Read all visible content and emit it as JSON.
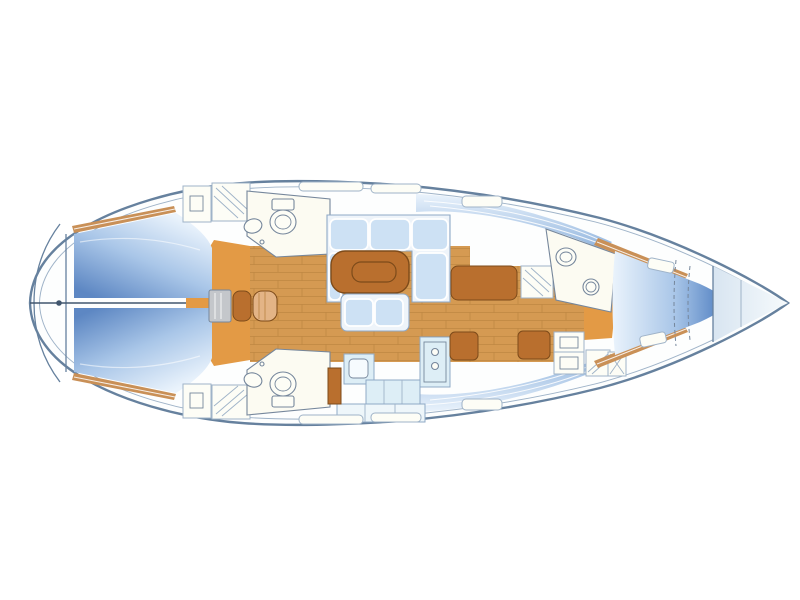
{
  "canvas": {
    "width": 800,
    "height": 600,
    "background": "#ffffff"
  },
  "diagram": {
    "type": "sailing-yacht-interior-floor-plan",
    "view": "top-down",
    "orientation": "bow-right-stern-left",
    "palette": {
      "line": "#66819e",
      "line_soft": "#9fb3c8",
      "accent_dark": "#41566e",
      "hull_fill": "#fdfefe",
      "berth_light": "#eaf3fc",
      "berth_mid": "#a9c6e8",
      "berth_deep": "#5d87c3",
      "vberth_deep": "#4c7cbf",
      "side_deep": "#8fb3dd",
      "bow_light": "#d8e5f1",
      "cushion": "#cde1f4",
      "cushion_edge": "#8fa9c6",
      "settee_base": "#eef4fa",
      "wood": "#d59a52",
      "wood_line": "#b5813c",
      "floor_orange": "#e39a45",
      "furniture_brown": "#b96f2e",
      "furniture_brown_dark": "#7d4b1a",
      "shelf_wood": "#c99057",
      "counter": "#ddeef6",
      "counter_light": "#eef6fa",
      "fixture_fill": "#fdfdf6",
      "fixture_line": "#76879c",
      "room_fill": "#fcfbf2",
      "steps_gray": "#c4c7cb"
    },
    "zones": [
      {
        "id": "stern-platform",
        "features": [
          "transom-curve",
          "backstay-fitting",
          "stern-bulkhead"
        ]
      },
      {
        "id": "aft-cabin-port",
        "features": [
          "double-berth",
          "hull-shelf",
          "hanging-lockers",
          "entry-floor"
        ]
      },
      {
        "id": "aft-cabin-starboard",
        "features": [
          "double-berth",
          "hull-shelf",
          "hanging-lockers",
          "entry-floor"
        ]
      },
      {
        "id": "aft-head-port",
        "features": [
          "toilet",
          "washbasin"
        ]
      },
      {
        "id": "aft-head-starboard",
        "features": [
          "toilet",
          "washbasin"
        ]
      },
      {
        "id": "companionway",
        "features": [
          "steps-box",
          "engine-box"
        ]
      },
      {
        "id": "saloon",
        "features": [
          "u-settee",
          "dining-table",
          "bench-seat",
          "plank-floor"
        ]
      },
      {
        "id": "galley",
        "features": [
          "sink-unit",
          "stove",
          "worktops",
          "refrigerator"
        ]
      },
      {
        "id": "forward-cabin",
        "features": [
          "bench-seat-port",
          "bench-seats-starboard",
          "wardrobe-locker",
          "vanity-lockers",
          "entry-floor"
        ]
      },
      {
        "id": "forward-head",
        "features": [
          "toilet",
          "washbasin"
        ]
      },
      {
        "id": "v-berth",
        "features": [
          "double-berth",
          "infill-cushion-dashes",
          "hull-shelves",
          "deck-hatches"
        ]
      },
      {
        "id": "anchor-locker",
        "features": [
          "bow-bulkhead",
          "inner-partition"
        ]
      }
    ]
  }
}
